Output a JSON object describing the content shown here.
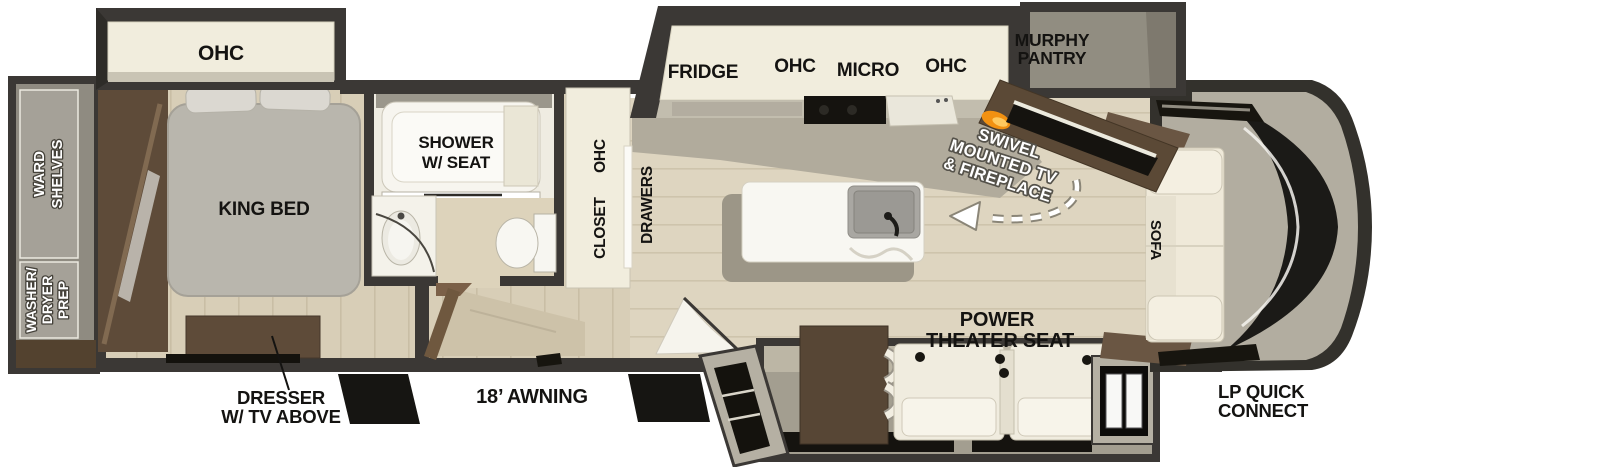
{
  "plan": {
    "rear": {
      "ward_line1": "WARD",
      "ward_line2": "SHELVES",
      "washer_line1": "WASHER/",
      "washer_line2": "DRYER",
      "washer_line3": "PREP"
    },
    "bedroom_slide": {
      "ohc_label": "OHC"
    },
    "bedroom": {
      "king_bed_label": "KING BED"
    },
    "bathroom": {
      "shower_line1": "SHOWER",
      "shower_line2": "W/ SEAT"
    },
    "hall": {
      "closet_label": "CLOSET",
      "closet_ohc_label": "OHC",
      "drawers_label": "DRAWERS"
    },
    "kitchen": {
      "fridge_label": "FRIDGE",
      "ohc_left_label": "OHC",
      "micro_label": "MICRO",
      "ohc_right_label": "OHC"
    },
    "pantry": {
      "line1": "MURPHY",
      "line2": "PANTRY"
    },
    "entertainment": {
      "line1": "SWIVEL",
      "line2": "MOUNTED TV",
      "line3": "& FIREPLACE"
    },
    "living": {
      "sofa_label": "SOFA",
      "theater_line1": "POWER",
      "theater_line2": "THEATER SEAT"
    },
    "annotations": {
      "awning_label": "18’ AWNING",
      "dresser_line1": "DRESSER",
      "dresser_line2": "W/ TV ABOVE",
      "lp_line1": "LP QUICK",
      "lp_line2": "CONNECT"
    }
  },
  "colors": {
    "wall_dark": "#3b3835",
    "cabinet_cream": "#f1eddd",
    "floor_wood": "#d8ceb7",
    "floor_living": "#ded5c0",
    "furniture_brown": "#5b4936",
    "fixture_white": "#f7f6f1",
    "flame_orange": "#f29111",
    "accent_black": "#17150f",
    "label_black": "#141311",
    "label_white": "#ffffff"
  }
}
